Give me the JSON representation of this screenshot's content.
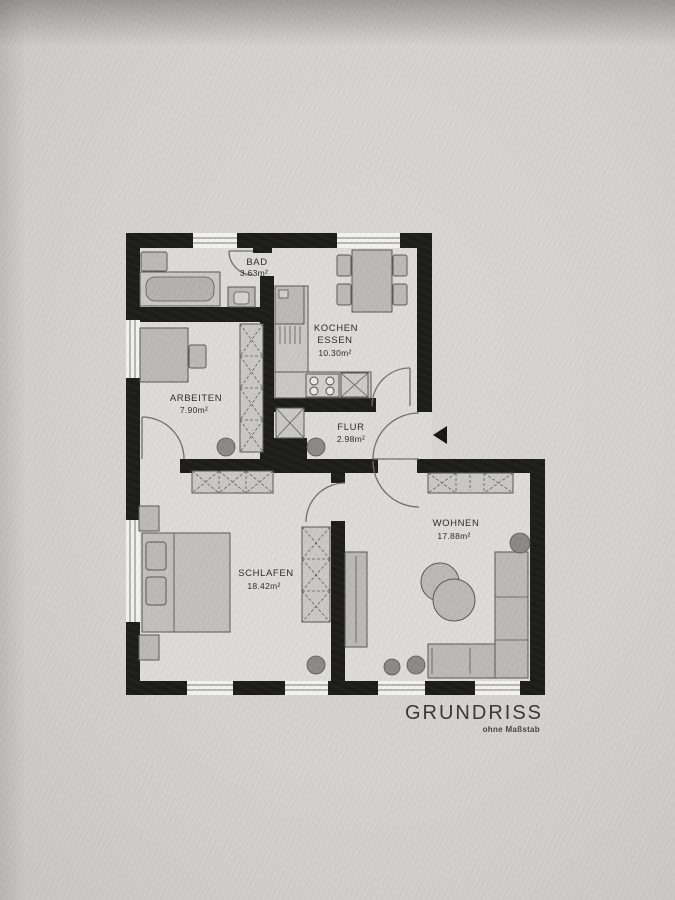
{
  "title": {
    "label": "GRUNDRISS",
    "subtitle": "ohne Maßstab"
  },
  "rooms": [
    {
      "id": "bad",
      "name": "BAD",
      "area": "3.63m²"
    },
    {
      "id": "kueche",
      "name": "KOCHEN",
      "name_line2": "ESSEN",
      "area": "10.30m²"
    },
    {
      "id": "arbeiten",
      "name": "ARBEITEN",
      "area": "7.90m²"
    },
    {
      "id": "flur",
      "name": "FLUR",
      "area": "2.98m²"
    },
    {
      "id": "schlafen",
      "name": "SCHLAFEN",
      "area": "18.42m²"
    },
    {
      "id": "wohnen",
      "name": "WOHNEN",
      "area": "17.88m²"
    }
  ],
  "colors": {
    "walls": "#1c1c1a",
    "paper": "#d3d2d0",
    "room_interior": "#dcdbd9",
    "furniture": "#bab9b7"
  }
}
